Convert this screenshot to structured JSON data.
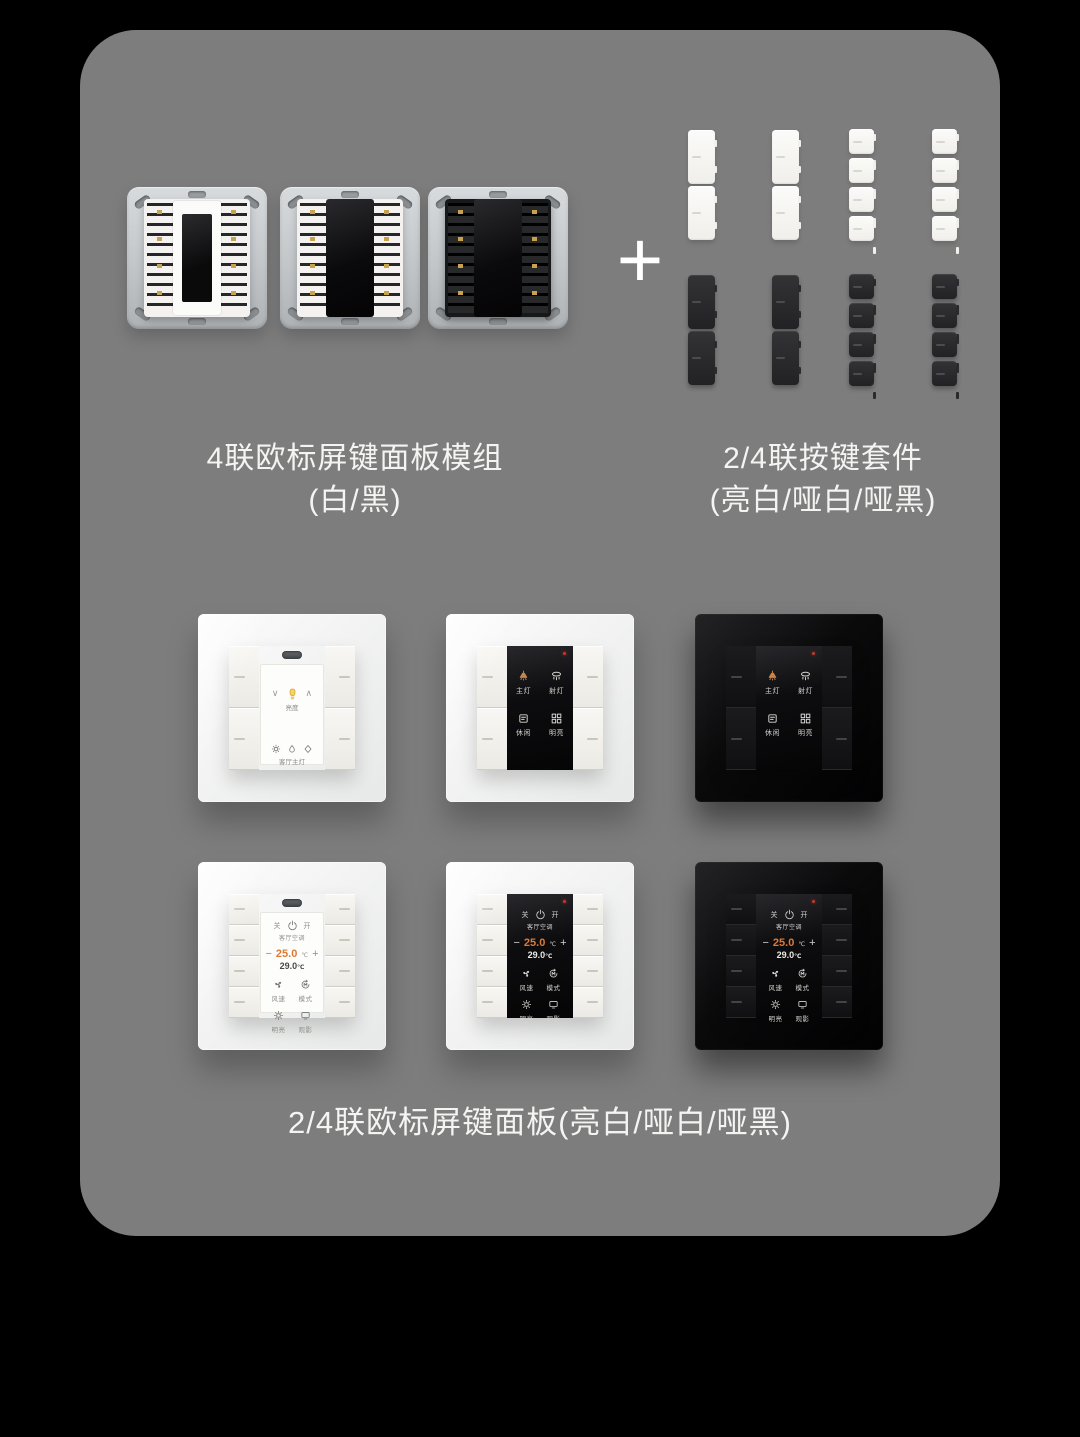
{
  "page": {
    "background": "#000000",
    "card_background": "#7d7d7d",
    "text_color": "#f4f4f3"
  },
  "colors": {
    "accent_orange": "#dd7a34",
    "led_red": "#c0392b",
    "module_gold_contacts": "#c9a24d",
    "panel_white": "#f2f3f2",
    "panel_black": "#0a0a0b"
  },
  "captions": {
    "plus": "+",
    "modules_line1": "4联欧标屏键面板模组",
    "modules_line2": "(白/黑)",
    "keycaps_line1": "2/4联按键套件",
    "keycaps_line2": "(亮白/哑白/哑黑)",
    "bottom": "2/4联欧标屏键面板(亮白/哑白/哑黑)"
  },
  "scene_screen": {
    "items": [
      {
        "icon": "pendant-light-icon",
        "label": "主灯"
      },
      {
        "icon": "downlight-icon",
        "label": "射灯"
      },
      {
        "icon": "leisure-icon",
        "label": "休闲"
      },
      {
        "icon": "bright-icon",
        "label": "明亮"
      }
    ]
  },
  "ac_screen": {
    "off_label": "关",
    "on_label": "开",
    "power_icon": "power-icon",
    "device_name": "客厅空调",
    "minus": "−",
    "plus": "+",
    "set_temp": "25.0",
    "set_unit": "℃",
    "room_temp": "29.0",
    "room_unit": "℃",
    "items": [
      {
        "icon": "fan-icon",
        "label": "风速"
      },
      {
        "icon": "mode-icon",
        "label": "模式"
      },
      {
        "icon": "sun-icon",
        "label": "明亮"
      },
      {
        "icon": "monitor-icon",
        "label": "观影"
      }
    ]
  },
  "dimmer_screen": {
    "down": "∨",
    "up": "∧",
    "bulb_icon": "bulb-icon",
    "brightness_label": "亮度",
    "icons": [
      "sun-icon",
      "drop-icon",
      "diamond-icon"
    ],
    "device_name": "客厅主灯"
  }
}
